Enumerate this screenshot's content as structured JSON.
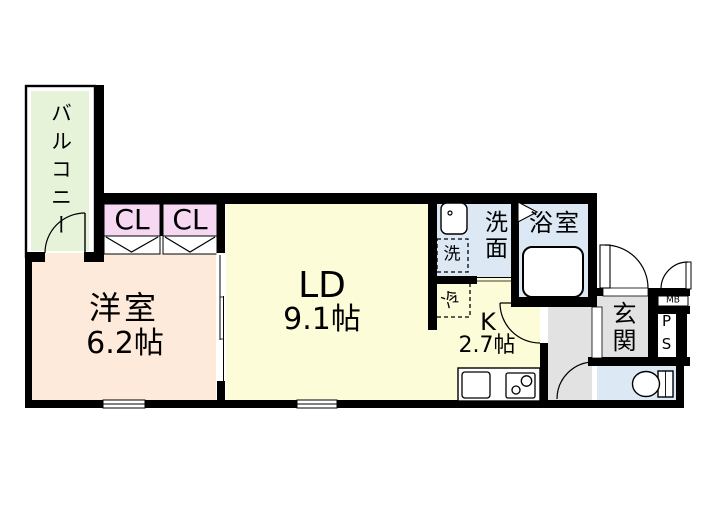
{
  "colors": {
    "wall": "#000000",
    "balcony_floor": "#e7f3d9",
    "closet_floor": "#f6d8f2",
    "western_room_floor": "#fdeada",
    "living_dining_floor": "#fdfcd8",
    "wet_area_floor": "#dce9f5",
    "entrance_floor": "#e2e2e2",
    "fixture": "#ffffff"
  },
  "rooms": {
    "balcony": {
      "label": "バルコニー"
    },
    "closet_left": {
      "label": "CL"
    },
    "closet_right": {
      "label": "CL"
    },
    "western_room": {
      "label": "洋室",
      "size": "6.2帖"
    },
    "living_dining": {
      "label": "LD",
      "size": "9.1帖"
    },
    "kitchen": {
      "label": "K",
      "size": "2.7帖"
    },
    "washroom": {
      "label": "洗面"
    },
    "bathroom": {
      "label": "浴室"
    },
    "entrance": {
      "label": "玄関"
    }
  },
  "fixtures": {
    "washing_machine": {
      "label": "洗"
    },
    "refrigerator": {
      "label": "冷"
    },
    "meter_box": {
      "label": "MB"
    },
    "pipe_space": {
      "label": "PS"
    }
  }
}
